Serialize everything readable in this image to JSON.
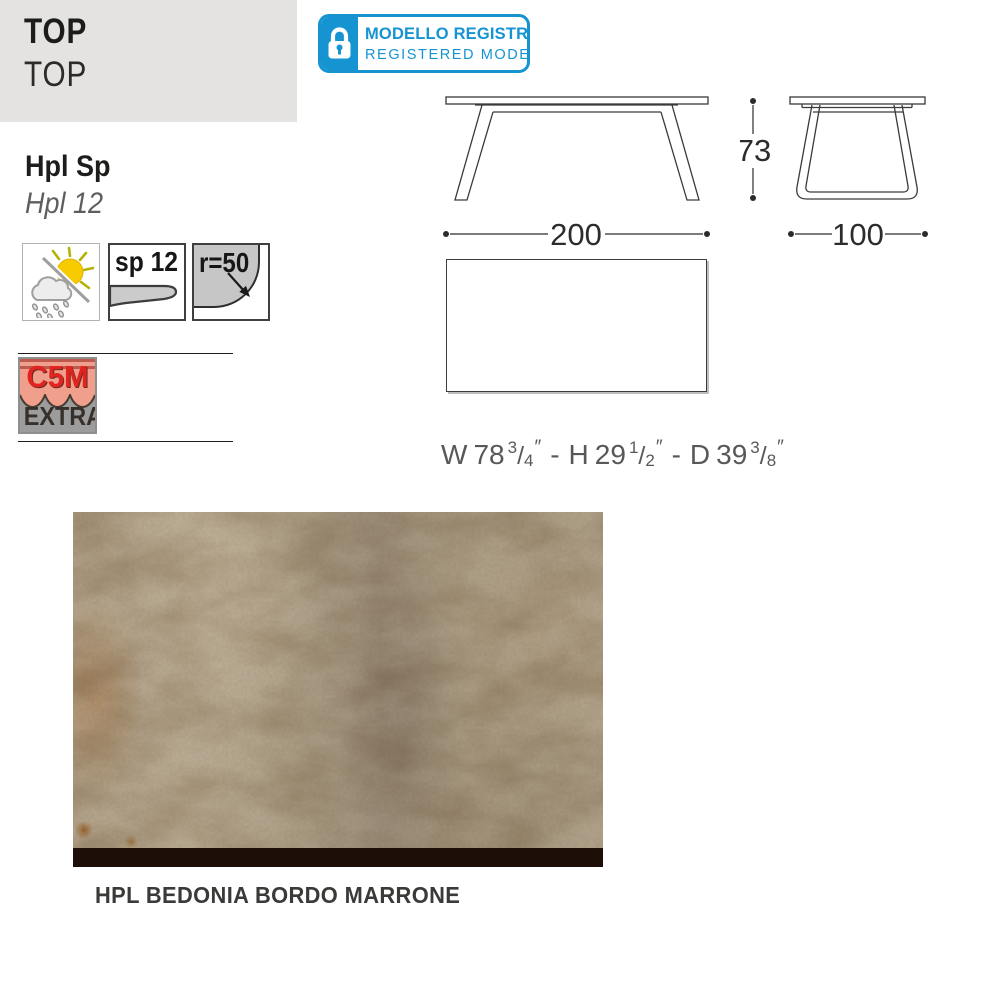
{
  "header": {
    "title": "TOP",
    "subtitle": "TOP",
    "bg": "#e4e3e2"
  },
  "badge": {
    "line1": "MODELLO REGISTRATO",
    "line2": "REGISTERED MODEL",
    "blue": "#1694d2",
    "icon": "lock-icon"
  },
  "materials": {
    "name_bold": "Hpl Sp",
    "name_italic": "Hpl 12"
  },
  "feature_icons": {
    "weather": "outdoor-weather-icon",
    "thickness_label": "sp 12",
    "radius_label": "r=50"
  },
  "certification": {
    "top_text": "C5M",
    "bottom_text": "EXTRA",
    "red": "#e22420",
    "salmon": "#ef9f8b",
    "gray": "#9c9c9c"
  },
  "drawings": {
    "front_width": "200",
    "side_height": "73",
    "side_depth": "100",
    "imperial": {
      "w_label": "W",
      "w_whole": "78",
      "w_num": "3",
      "w_den": "4",
      "h_label": "H",
      "h_whole": "29",
      "h_num": "1",
      "h_den": "2",
      "d_label": "D",
      "d_whole": "39",
      "d_num": "3",
      "d_den": "8",
      "slash": "/",
      "inch": "″",
      "sep": "-"
    }
  },
  "swatch": {
    "caption": "HPL BEDONIA BORDO MARRONE",
    "edge_color": "#1e0e08"
  }
}
